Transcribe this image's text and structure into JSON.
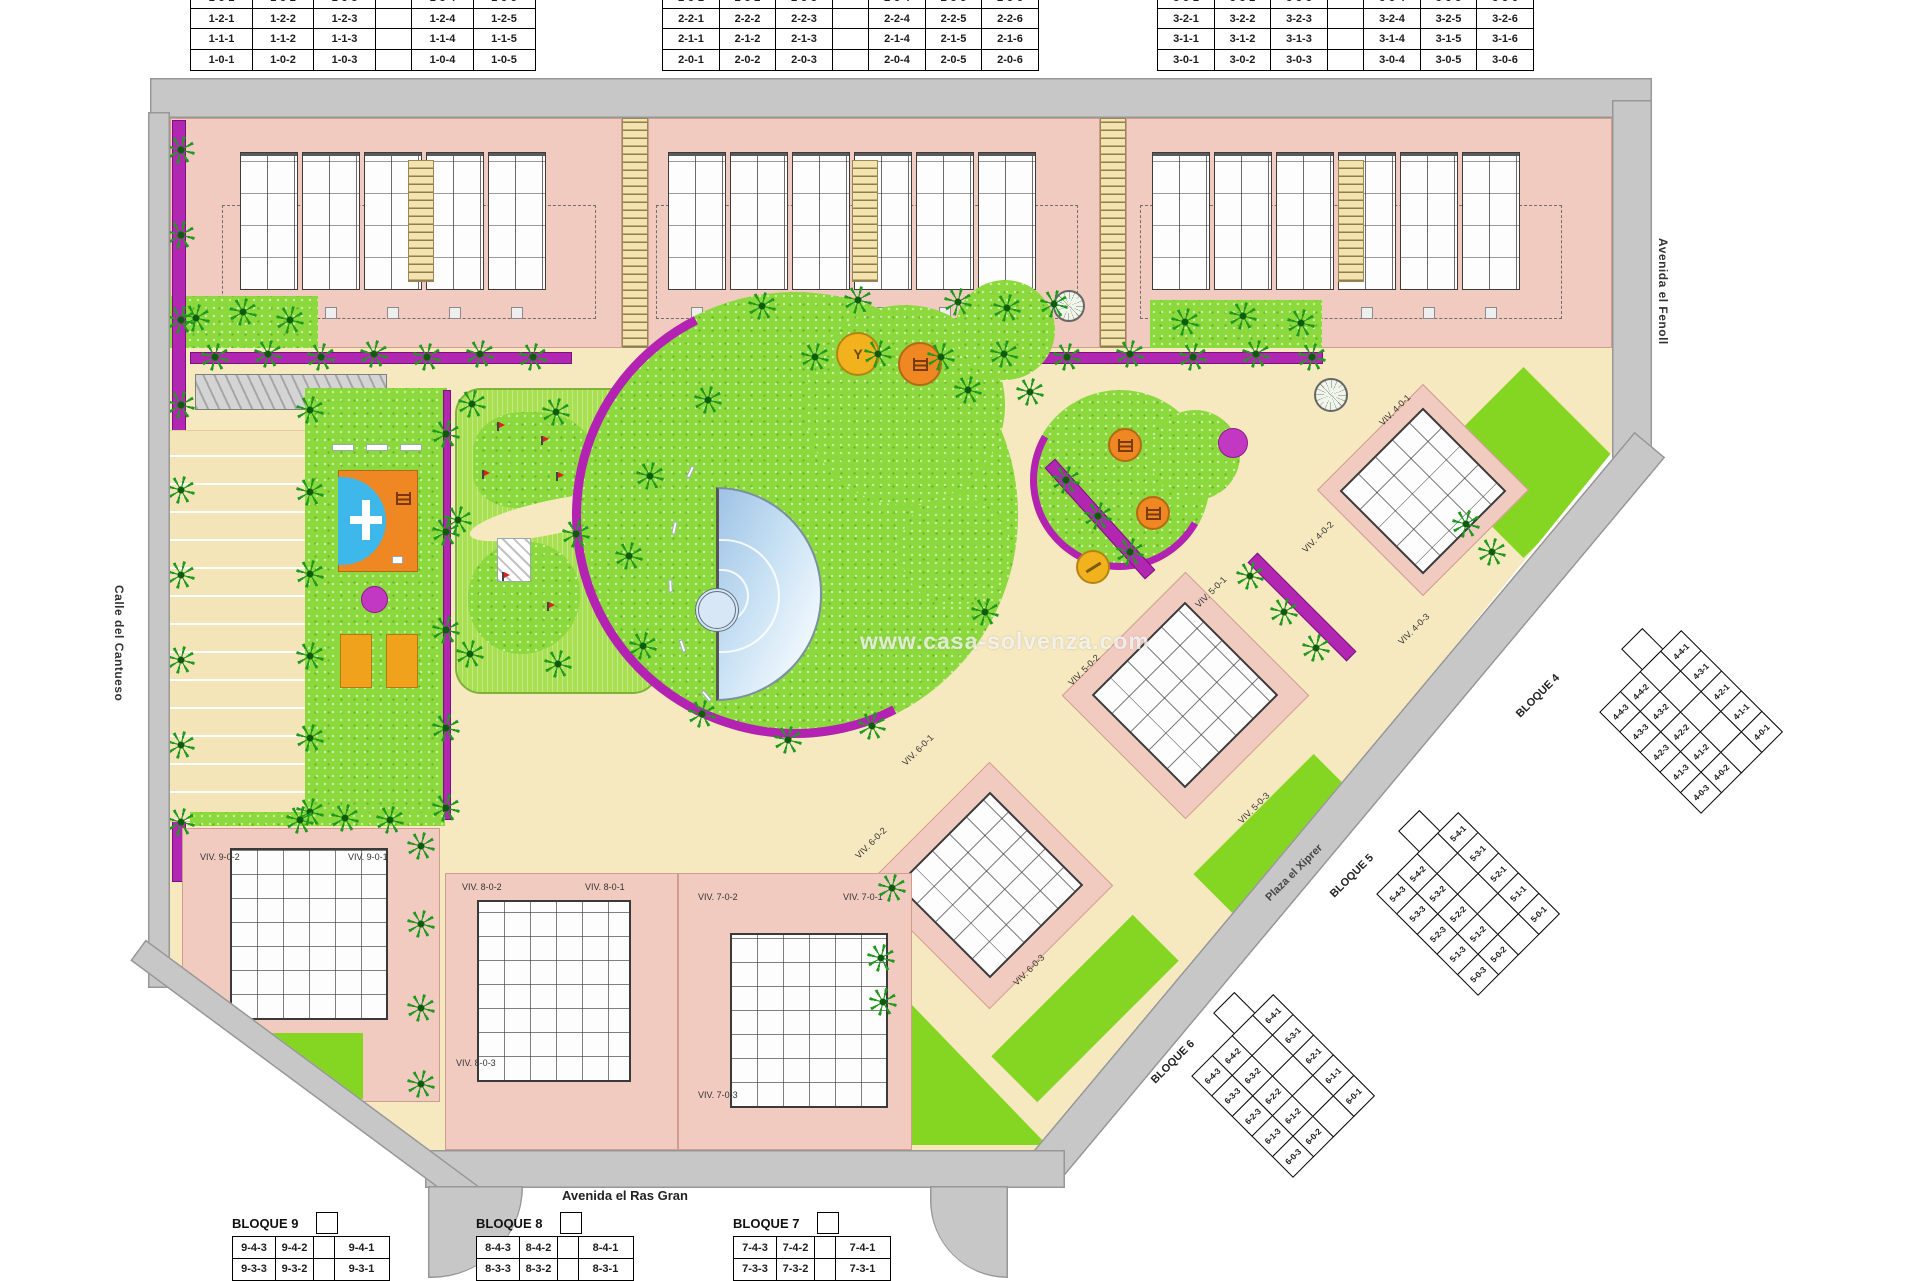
{
  "colors": {
    "road": "#c7c7c7",
    "cream": "#f6e8bf",
    "pink": "#f2cbc0",
    "grass": "#8cd93d",
    "lime": "#85d622",
    "hedge_magenta": "#b227b2",
    "pool_blue": "#a9c9e4",
    "orange": "#ef8722",
    "yellow": "#f2b21d"
  },
  "watermark": "www.casa-solvenza.com",
  "streets": {
    "right": "Avenida el Fenoll",
    "left": "Calle del Cantueso",
    "bottom": "Avenida el Ras Gran",
    "plaza": "Plaza el Xiprer"
  },
  "tables": {
    "b1": {
      "rows": [
        [
          "1-3-1",
          "1-3-2",
          "1-3-3",
          "",
          "1-3-4",
          "1-3-5"
        ],
        [
          "1-2-1",
          "1-2-2",
          "1-2-3",
          "",
          "1-2-4",
          "1-2-5"
        ],
        [
          "1-1-1",
          "1-1-2",
          "1-1-3",
          "",
          "1-1-4",
          "1-1-5"
        ],
        [
          "1-0-1",
          "1-0-2",
          "1-0-3",
          "",
          "1-0-4",
          "1-0-5"
        ]
      ]
    },
    "b2": {
      "rows": [
        [
          "2-3-1",
          "2-3-2",
          "2-3-3",
          "",
          "2-3-4",
          "2-3-5",
          "2-3-6"
        ],
        [
          "2-2-1",
          "2-2-2",
          "2-2-3",
          "",
          "2-2-4",
          "2-2-5",
          "2-2-6"
        ],
        [
          "2-1-1",
          "2-1-2",
          "2-1-3",
          "",
          "2-1-4",
          "2-1-5",
          "2-1-6"
        ],
        [
          "2-0-1",
          "2-0-2",
          "2-0-3",
          "",
          "2-0-4",
          "2-0-5",
          "2-0-6"
        ]
      ]
    },
    "b3": {
      "rows": [
        [
          "3-3-1",
          "3-3-2",
          "3-3-3",
          "",
          "3-3-4",
          "3-3-5",
          "3-3-6"
        ],
        [
          "3-2-1",
          "3-2-2",
          "3-2-3",
          "",
          "3-2-4",
          "3-2-5",
          "3-2-6"
        ],
        [
          "3-1-1",
          "3-1-2",
          "3-1-3",
          "",
          "3-1-4",
          "3-1-5",
          "3-1-6"
        ],
        [
          "3-0-1",
          "3-0-2",
          "3-0-3",
          "",
          "3-0-4",
          "3-0-5",
          "3-0-6"
        ]
      ]
    },
    "b4": {
      "label": "BLOQUE 4",
      "rows": [
        [
          "4-4-3",
          "4-4-2",
          "",
          "4-4-1"
        ],
        [
          "4-3-3",
          "4-3-2",
          "",
          "4-3-1"
        ],
        [
          "4-2-3",
          "4-2-2",
          "",
          "4-2-1"
        ],
        [
          "4-1-3",
          "4-1-2",
          "",
          "4-1-1"
        ],
        [
          "4-0-3",
          "4-0-2",
          "",
          "4-0-1"
        ]
      ]
    },
    "b5": {
      "label": "BLOQUE 5",
      "rows": [
        [
          "5-4-3",
          "5-4-2",
          "",
          "5-4-1"
        ],
        [
          "5-3-3",
          "5-3-2",
          "",
          "5-3-1"
        ],
        [
          "5-2-3",
          "5-2-2",
          "",
          "5-2-1"
        ],
        [
          "5-1-3",
          "5-1-2",
          "",
          "5-1-1"
        ],
        [
          "5-0-3",
          "5-0-2",
          "",
          "5-0-1"
        ]
      ]
    },
    "b6": {
      "label": "BLOQUE 6",
      "rows": [
        [
          "6-4-3",
          "6-4-2",
          "",
          "6-4-1"
        ],
        [
          "6-3-3",
          "6-3-2",
          "",
          "6-3-1"
        ],
        [
          "6-2-3",
          "6-2-2",
          "",
          "6-2-1"
        ],
        [
          "6-1-3",
          "6-1-2",
          "",
          "6-1-1"
        ],
        [
          "6-0-3",
          "6-0-2",
          "",
          "6-0-1"
        ]
      ]
    },
    "b7": {
      "label": "BLOQUE 7",
      "rows": [
        [
          "7-4-3",
          "7-4-2",
          "",
          "7-4-1"
        ],
        [
          "7-3-3",
          "7-3-2",
          "",
          "7-3-1"
        ]
      ]
    },
    "b8": {
      "label": "BLOQUE 8",
      "rows": [
        [
          "8-4-3",
          "8-4-2",
          "",
          "8-4-1"
        ],
        [
          "8-3-3",
          "8-3-2",
          "",
          "8-3-1"
        ]
      ]
    },
    "b9": {
      "label": "BLOQUE 9",
      "rows": [
        [
          "9-4-3",
          "9-4-2",
          "",
          "9-4-1"
        ],
        [
          "9-3-3",
          "9-3-2",
          "",
          "9-3-1"
        ]
      ]
    }
  },
  "units": {
    "u401": "VIV. 4-0-1",
    "u402": "VIV. 4-0-2",
    "u403": "VIV. 4-0-3",
    "u501": "VIV. 5-0-1",
    "u502": "VIV. 5-0-2",
    "u503": "VIV. 5-0-3",
    "u601": "VIV. 6-0-1",
    "u602": "VIV. 6-0-2",
    "u603": "VIV. 6-0-3",
    "u701": "VIV. 7-0-1",
    "u702": "VIV. 7-0-2",
    "u703": "VIV. 7-0-3",
    "u801": "VIV. 8-0-1",
    "u802": "VIV. 8-0-2",
    "u803": "VIV. 8-0-3",
    "u901": "VIV. 9-0-1",
    "u902": "VIV. 9-0-2",
    "u903": "VIV. 9-0-3"
  }
}
